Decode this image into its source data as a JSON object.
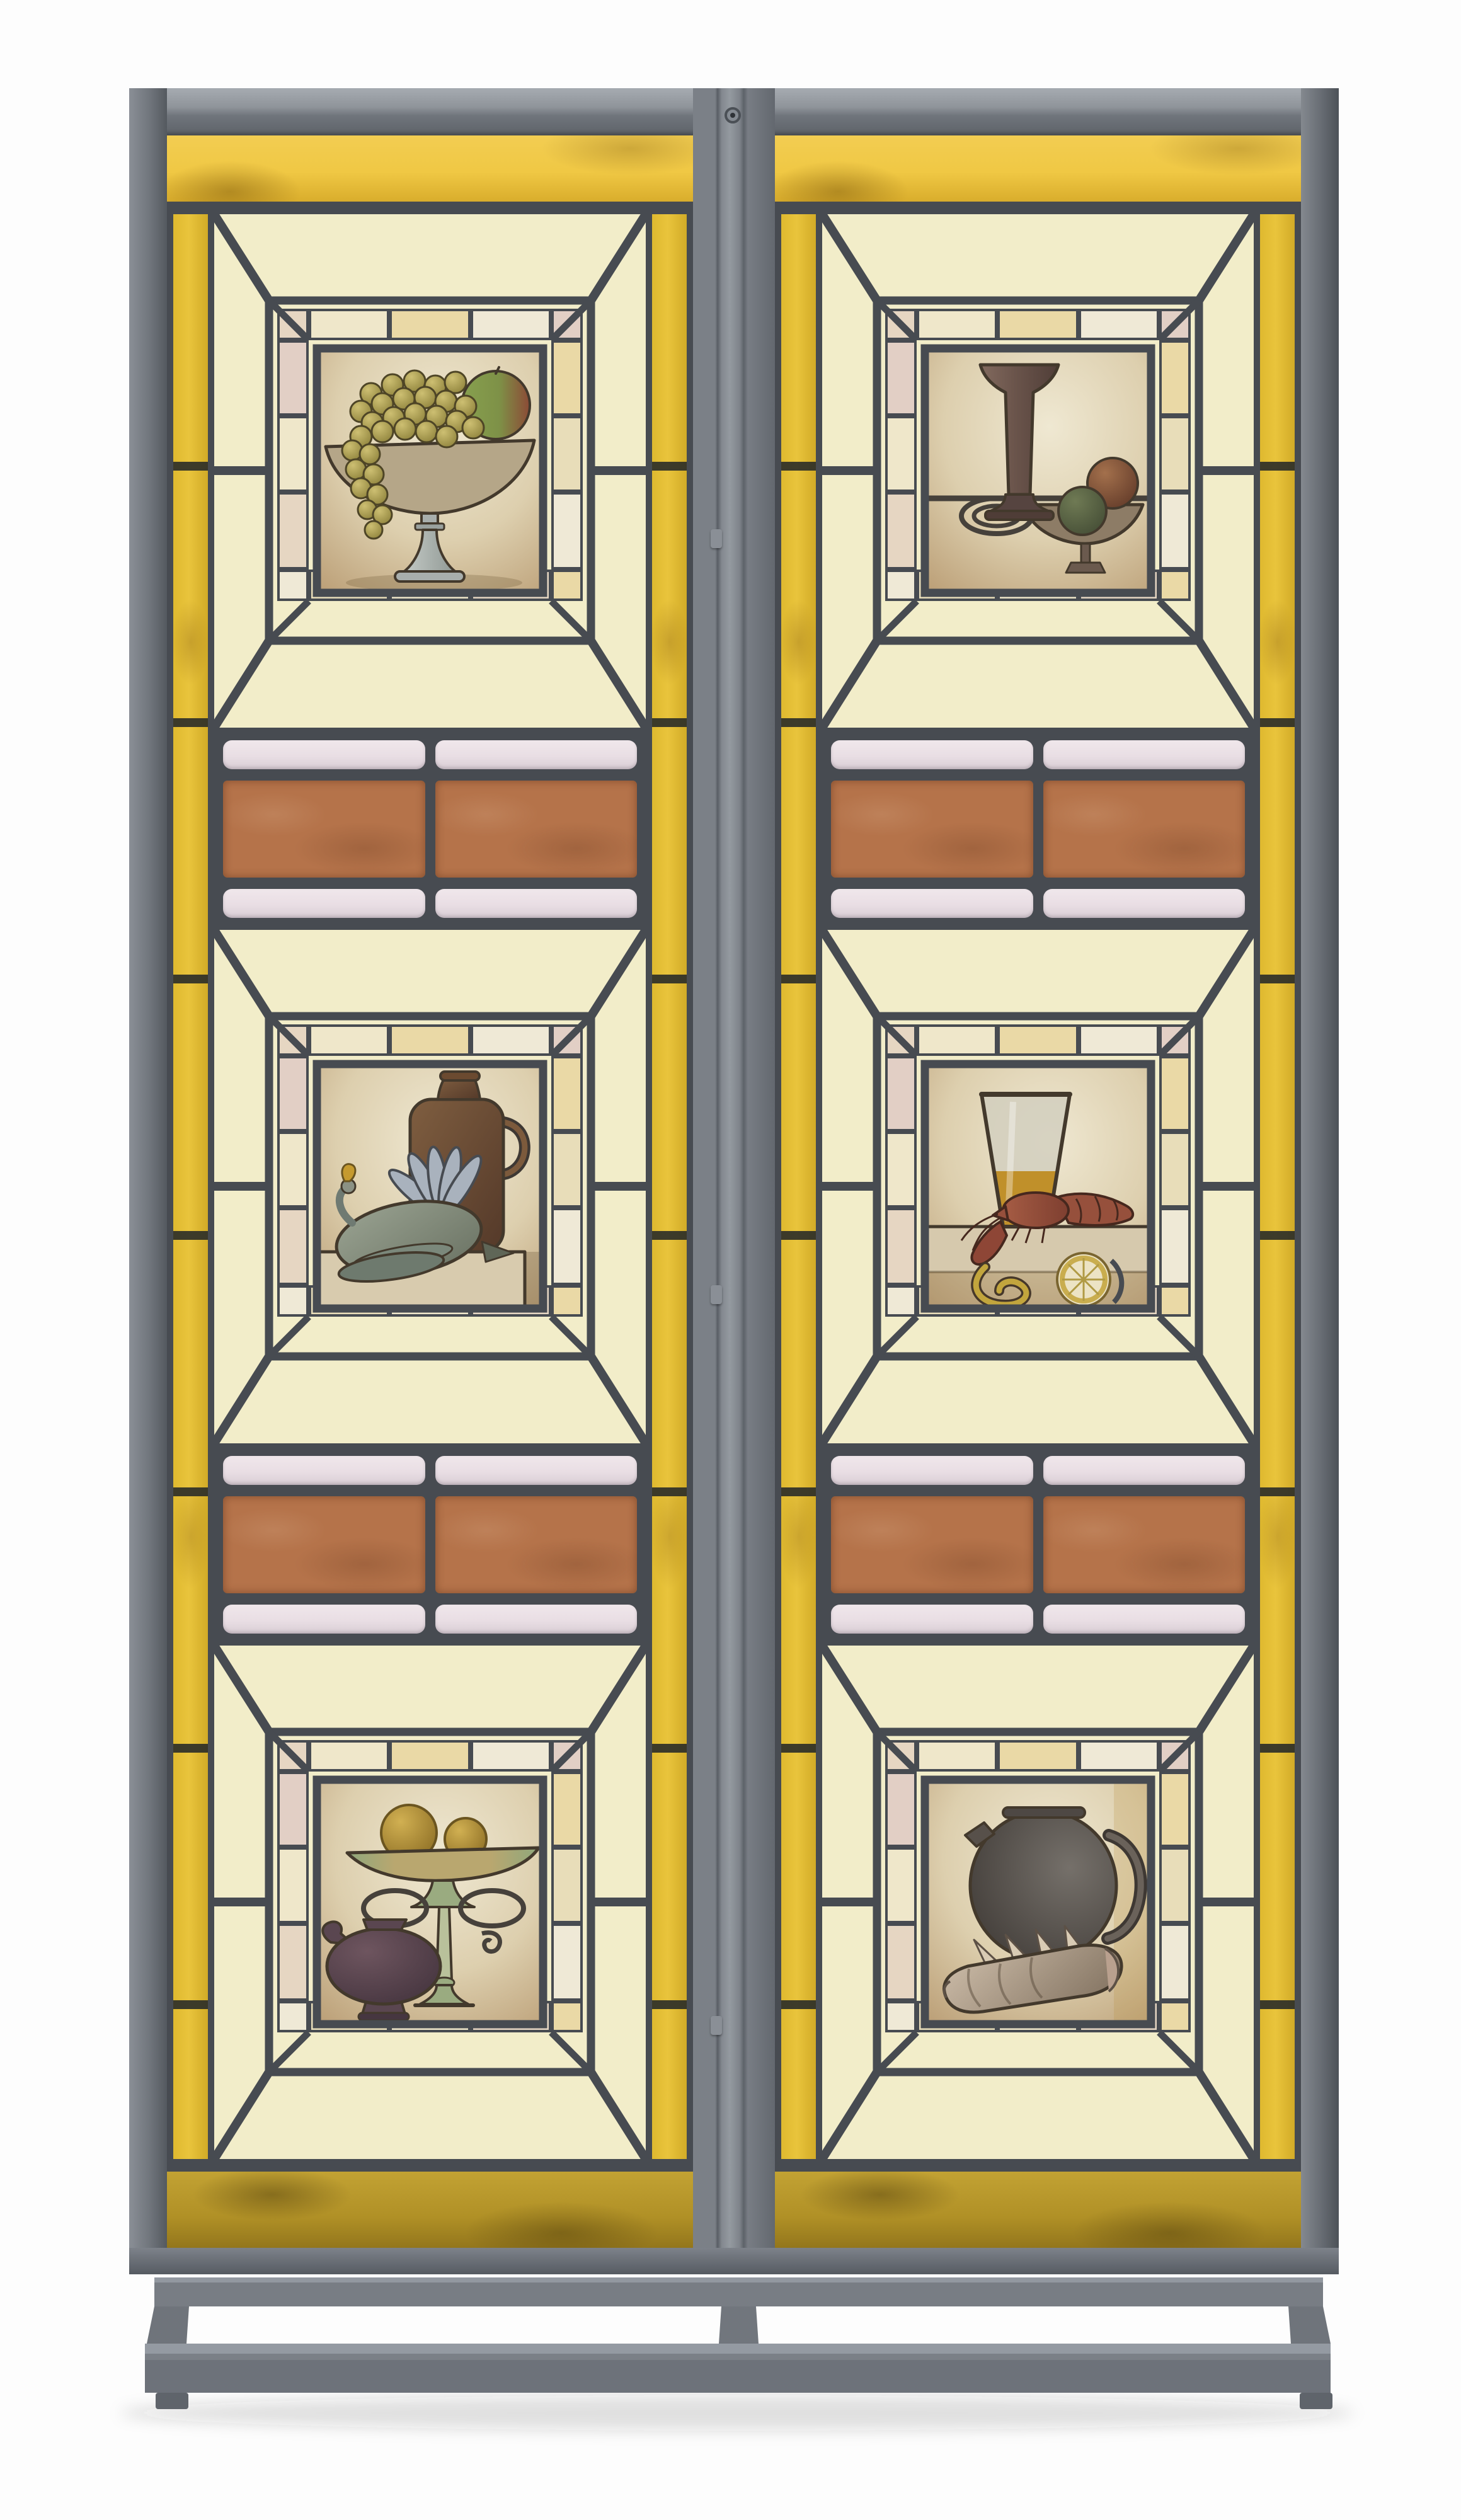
{
  "artwork": {
    "kind": "two-panel leaded and painted stained-glass screen on a grey metal stand",
    "panel_count": 2,
    "sections_per_panel": 3,
    "scenes": {
      "left": [
        "compote-with-grapes-and-apple",
        "stoneware-jug-with-game-bird",
        "fruit-tazza-with-oil-lamp"
      ],
      "right": [
        "trumpet-vase-with-fruit-dish",
        "beer-glass-with-lobster-and-lemon",
        "round-jug-with-conch-shell"
      ]
    }
  },
  "colors": {
    "backdrop": "#fdfdfd",
    "frame": "#70757c",
    "frame-light": "#9aa0a6",
    "frame-dark": "#565b62",
    "lead": "#474b51",
    "cream": "#f2edc9",
    "yellow": "#e9c43c",
    "yellow-bright": "#f0c844",
    "amber": "#b09026",
    "pink": "#e9dee4",
    "terracotta": "#b5734a"
  }
}
